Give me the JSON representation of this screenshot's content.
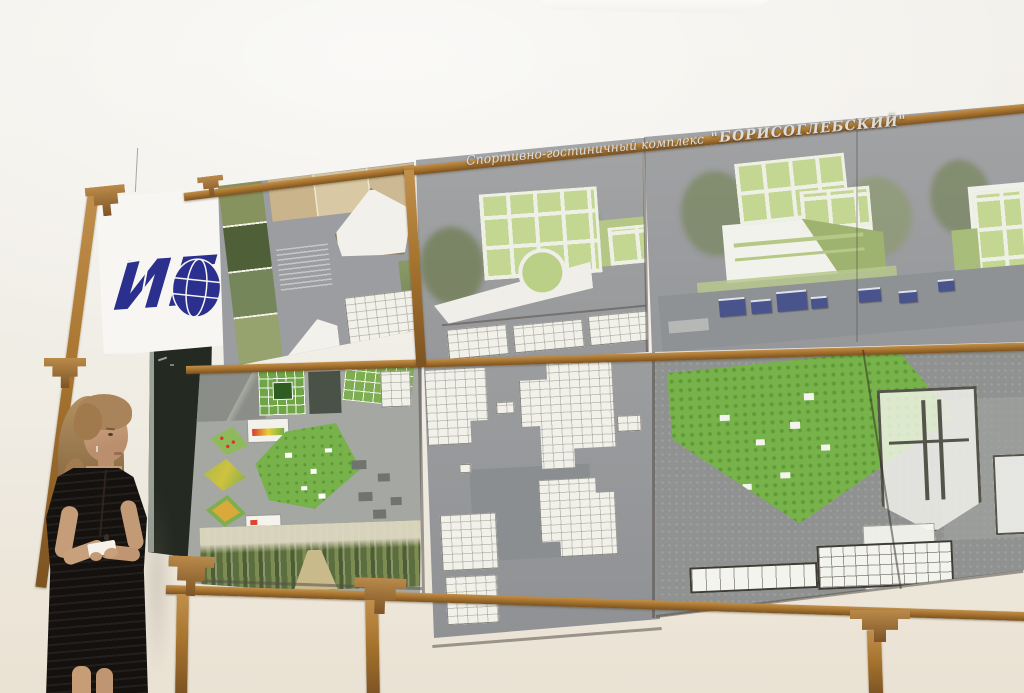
{
  "scene": {
    "description": "Presenter standing beside architectural competition boards on a wooden exhibition frame"
  },
  "poster": {
    "title_script": "Спортивно-гостиничный комплекс",
    "title_name": "\"БОРИСОГЛЕБСКИЙ\""
  },
  "banner": {
    "logo_text": "ИГ"
  },
  "colors": {
    "wall": "#f1efe9",
    "wallWarm": "#eae2d3",
    "wood": "#a8752f",
    "woodDark": "#7c5322",
    "boardGray": "#9b9da0",
    "planWhite": "#f1f1ea",
    "glassGreen": "#c3d792",
    "parkGreen": "#77b24a",
    "logoBlue": "#2b2f8e",
    "chalkboard": "#242a21",
    "dressBlack": "#15110e",
    "hair": "#a9835a",
    "skin": "#c69d79"
  }
}
